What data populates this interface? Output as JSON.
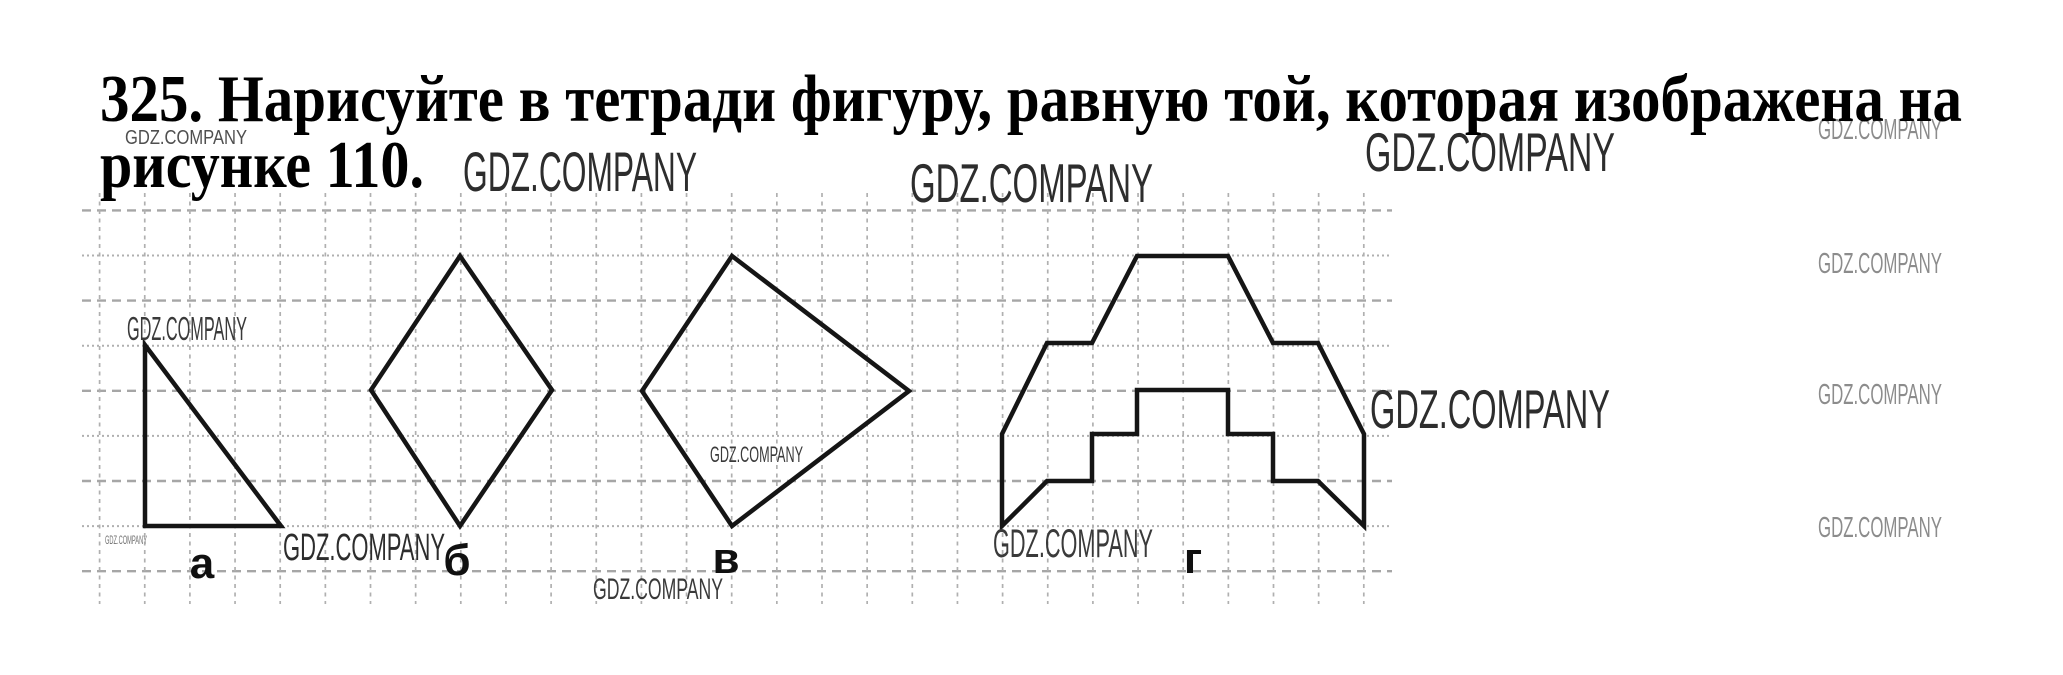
{
  "page": {
    "width": 2063,
    "height": 675,
    "background": "#ffffff"
  },
  "task": {
    "line1": "325. Нарисуйте в тетради фигуру, равную той, которая изображена на",
    "line2": "рисунке 110.",
    "color": "#000000",
    "line1_layout": {
      "x": 100,
      "y": 121,
      "size": 67,
      "length": 1862
    },
    "line2_layout": {
      "x": 100,
      "y": 187,
      "size": 67,
      "length": 324
    }
  },
  "grid": {
    "h_lines": {
      "y0": 210.4,
      "step": 45.1,
      "count": 9,
      "x1": 82,
      "x2": 1392,
      "dash_a": "9 6",
      "dash_b": "2 3",
      "width_a": 2.4,
      "width_b": 2.0,
      "color_a": "#a6a6a6",
      "color_b": "#b0b0b0"
    },
    "v_lines": {
      "x0": 99.6,
      "step": 45.15,
      "count": 29,
      "y1": 193,
      "y2": 604,
      "dash": "4 4.5",
      "width": 1.7,
      "color": "#b0b0b0"
    }
  },
  "figure_style": {
    "stroke": "#151515",
    "stroke_width": 4.5
  },
  "label_style": {
    "size": 44,
    "color": "#101010"
  },
  "figures": [
    {
      "id": "a",
      "label": "а",
      "label_x": 202,
      "label_y": 578,
      "points": [
        [
          145,
          345
        ],
        [
          145,
          526
        ],
        [
          281,
          526
        ]
      ]
    },
    {
      "id": "b",
      "label": "б",
      "label_x": 457,
      "label_y": 575,
      "points": [
        [
          460,
          256
        ],
        [
          552,
          390
        ],
        [
          460,
          526
        ],
        [
          371,
          390
        ]
      ]
    },
    {
      "id": "v",
      "label": "в",
      "label_x": 726,
      "label_y": 573,
      "points": [
        [
          732,
          256
        ],
        [
          909,
          391
        ],
        [
          732,
          526
        ],
        [
          642,
          391
        ]
      ]
    },
    {
      "id": "g",
      "label": "г",
      "label_x": 1193,
      "label_y": 573,
      "points": [
        [
          1137,
          256
        ],
        [
          1228,
          256
        ],
        [
          1273,
          343
        ],
        [
          1318,
          343
        ],
        [
          1364,
          434
        ],
        [
          1364,
          526
        ],
        [
          1318,
          481
        ],
        [
          1273,
          481
        ],
        [
          1273,
          434
        ],
        [
          1228,
          434
        ],
        [
          1228,
          390
        ],
        [
          1137,
          390
        ],
        [
          1137,
          434
        ],
        [
          1092,
          434
        ],
        [
          1092,
          481
        ],
        [
          1047,
          481
        ],
        [
          1002,
          526
        ],
        [
          1002,
          434
        ],
        [
          1047,
          343
        ],
        [
          1092,
          343
        ]
      ]
    }
  ],
  "watermarks": [
    {
      "text": "GDZ.COMPANY",
      "x": 125,
      "y": 144,
      "size": 20,
      "length": 122,
      "color": "#4f4f4f"
    },
    {
      "text": "GDZ.COMPANY",
      "x": 463,
      "y": 191,
      "size": 56,
      "length": 234,
      "color": "#2d2d2d"
    },
    {
      "text": "GDZ.COMPANY",
      "x": 910,
      "y": 202,
      "size": 55,
      "length": 243,
      "color": "#2d2d2d"
    },
    {
      "text": "GDZ.COMPANY",
      "x": 1365,
      "y": 171,
      "size": 55,
      "length": 250,
      "color": "#2d2d2d"
    },
    {
      "text": "GDZ.COMPANY",
      "x": 1818,
      "y": 139,
      "size": 29,
      "length": 124,
      "color": "#8c8c8c"
    },
    {
      "text": "GDZ.COMPANY",
      "x": 1818,
      "y": 273,
      "size": 29,
      "length": 124,
      "color": "#8c8c8c"
    },
    {
      "text": "GDZ.COMPANY",
      "x": 1818,
      "y": 404,
      "size": 29,
      "length": 124,
      "color": "#8c8c8c"
    },
    {
      "text": "GDZ.COMPANY",
      "x": 1818,
      "y": 537,
      "size": 29,
      "length": 124,
      "color": "#8c8c8c"
    },
    {
      "text": "GDZ.COMPANY",
      "x": 127,
      "y": 340,
      "size": 33,
      "length": 120,
      "color": "#3a3a3a"
    },
    {
      "text": "GDZ.COMPANY",
      "x": 105,
      "y": 544,
      "size": 12,
      "length": 42,
      "color": "#6f6f6f"
    },
    {
      "text": "GDZ.COMPANY",
      "x": 283,
      "y": 560,
      "size": 38,
      "length": 162,
      "color": "#2d2d2d"
    },
    {
      "text": "GDZ.COMPANY",
      "x": 710,
      "y": 462,
      "size": 22,
      "length": 93,
      "color": "#3a3a3a"
    },
    {
      "text": "GDZ.COMPANY",
      "x": 593,
      "y": 599,
      "size": 30,
      "length": 130,
      "color": "#3a3a3a"
    },
    {
      "text": "GDZ.COMPANY",
      "x": 1370,
      "y": 428,
      "size": 55,
      "length": 240,
      "color": "#2d2d2d"
    },
    {
      "text": "GDZ.COMPANY",
      "x": 993,
      "y": 557,
      "size": 40,
      "length": 160,
      "color": "#3a3a3a"
    }
  ]
}
